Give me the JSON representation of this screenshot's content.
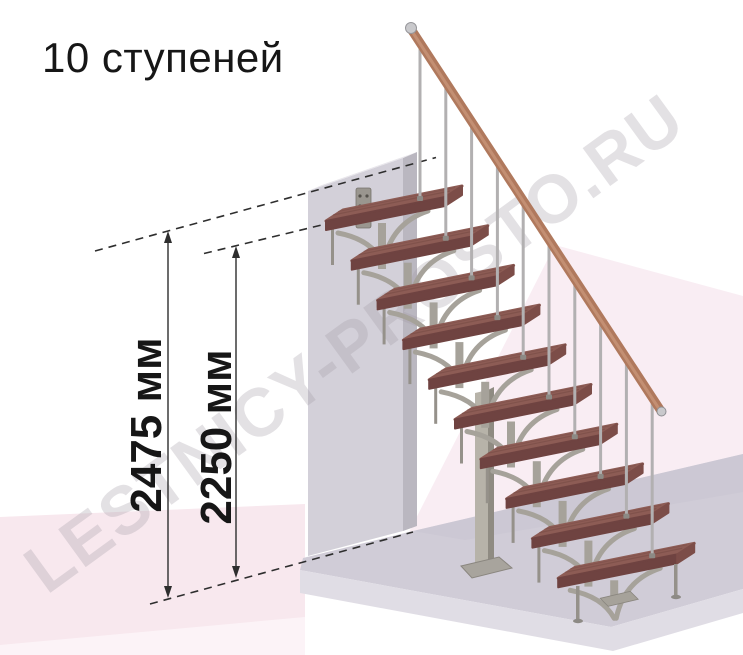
{
  "header": {
    "title": "10 ступеней"
  },
  "watermark": {
    "text": "LESTNICY-PROSTO.RU"
  },
  "dimensions": {
    "total_height": {
      "label": "2475 мм",
      "value_mm": 2475
    },
    "top_step_height": {
      "label": "2250 мм",
      "value_mm": 2250
    }
  },
  "diagram": {
    "type": "staircase-elevation",
    "steps_count": 10
  },
  "colors": {
    "bg": "#ffffff",
    "bg_pink": "#f8e8ee",
    "bg_pink_right": "#f9edf3",
    "bg_pink_pale": "#fcf3f7",
    "floor_top": "#d0ccd7",
    "floor_back": "#c9c5d1",
    "floor_front": "#e0dde5",
    "wall_front": "#d3d0d9",
    "wall_side": "#bab7c0",
    "wall_top": "#e8e6eb",
    "bracket": "#9a968f",
    "bracket_hole": "#55524c",
    "wood_top": "#8d5c55",
    "wood_streak": "#764a44",
    "wood_front": "#6f4341",
    "wood_end": "#7c4d48",
    "metal": "#a6a29a",
    "metal_thin": "#95918a",
    "column": "#b7b3a9",
    "column_side": "#8f8b82",
    "column_base": "#a8a49d",
    "baluster": "#b2b0b1",
    "baluster_base": "#8d8a85",
    "handrail": "#b0795d",
    "handrail_light": "#c89579",
    "rail_cap": "#c9c9cc",
    "dim": "#2e2e2e",
    "text": "#161616",
    "watermark": "rgba(162,156,166,0.30)"
  }
}
